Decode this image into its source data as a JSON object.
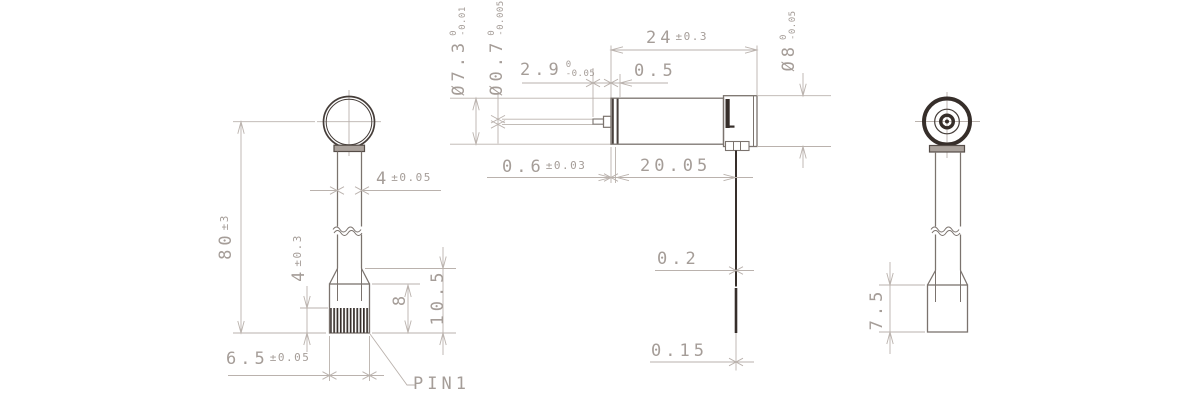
{
  "drawing_type": "engineering-drawing-3-view-motor",
  "colors": {
    "background": "#ffffff",
    "outline": "#7b736e",
    "dark_detail": "#362e2a",
    "dimension_lines": "#bab2ad",
    "dimension_text": "#a59d98"
  },
  "dims": {
    "left_view": {
      "overall_height": {
        "value": "80",
        "tol": "±3"
      },
      "stem_width": {
        "value": "4",
        "tol": "±0.05"
      },
      "pin_exposed_length": {
        "value": "4",
        "tol": "±0.3"
      },
      "base_height": {
        "value": "8"
      },
      "holder_height": {
        "value": "10.5"
      },
      "base_width": {
        "value": "6.5",
        "tol": "±0.05"
      },
      "pin_label": "PIN1"
    },
    "front_view": {
      "body_diameter": {
        "value": "Ø7.3",
        "tol_upper": "0",
        "tol_lower": "-0.01"
      },
      "shaft_diameter": {
        "value": "Ø0.7",
        "tol_upper": "0",
        "tol_lower": "-0.005"
      },
      "shaft_length": {
        "value": "2.9",
        "tol_upper": "0",
        "tol_lower": "-0.05"
      },
      "cap_thickness": {
        "value": "0.5"
      },
      "body_length": {
        "value": "24",
        "tol": "±0.3"
      },
      "end_cap_diameter": {
        "value": "Ø8",
        "tol_upper": "0",
        "tol_lower": "-0.05"
      },
      "front_flange_thickness": {
        "value": "0.6",
        "tol": "±0.03"
      },
      "terminal_position": {
        "value": "20.05"
      },
      "lead_wire_diameter": {
        "value": "0.2"
      },
      "lead_wire_tip_diameter": {
        "value": "0.15"
      }
    },
    "side_view": {
      "base_depth": {
        "value": "7.5"
      }
    }
  }
}
